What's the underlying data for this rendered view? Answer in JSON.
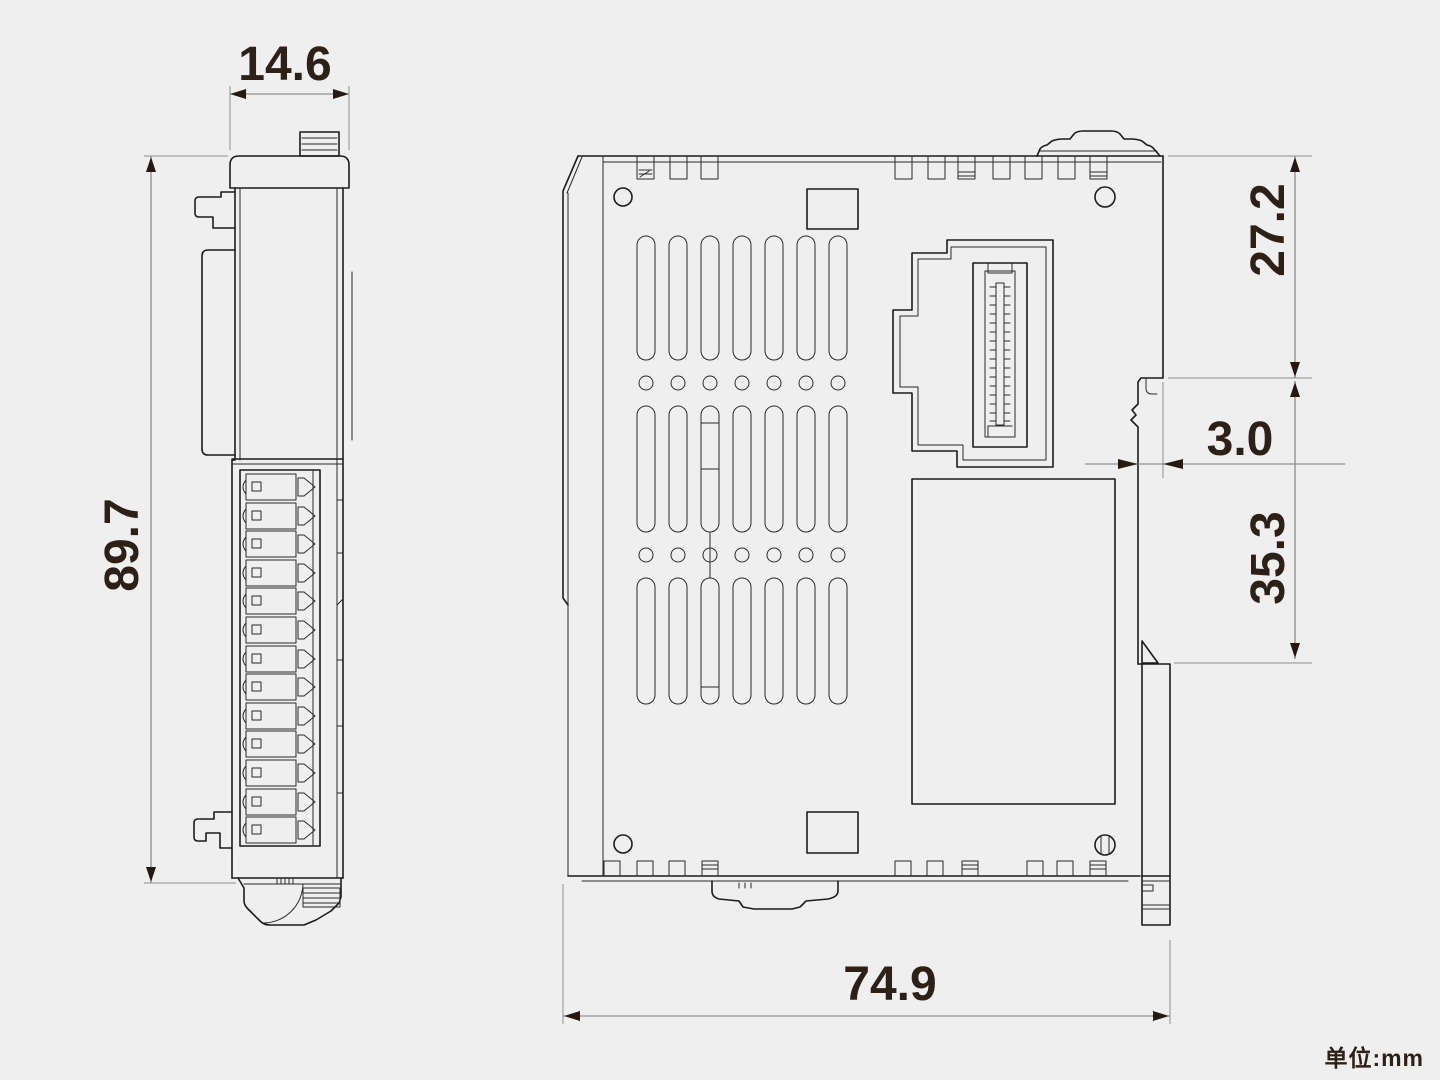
{
  "drawing": {
    "unit_note": "单位:mm",
    "dimensions": {
      "side_width": "14.6",
      "side_height": "89.7",
      "front_upper_height": "27.2",
      "rail_recess_depth": "3.0",
      "rail_lower_height": "35.3",
      "front_width": "74.9"
    },
    "colors": {
      "background": "#efefef",
      "outline": "#1c1c1c",
      "dimension_line": "#7b7b7b",
      "dimension_text": "#2c2017"
    }
  }
}
